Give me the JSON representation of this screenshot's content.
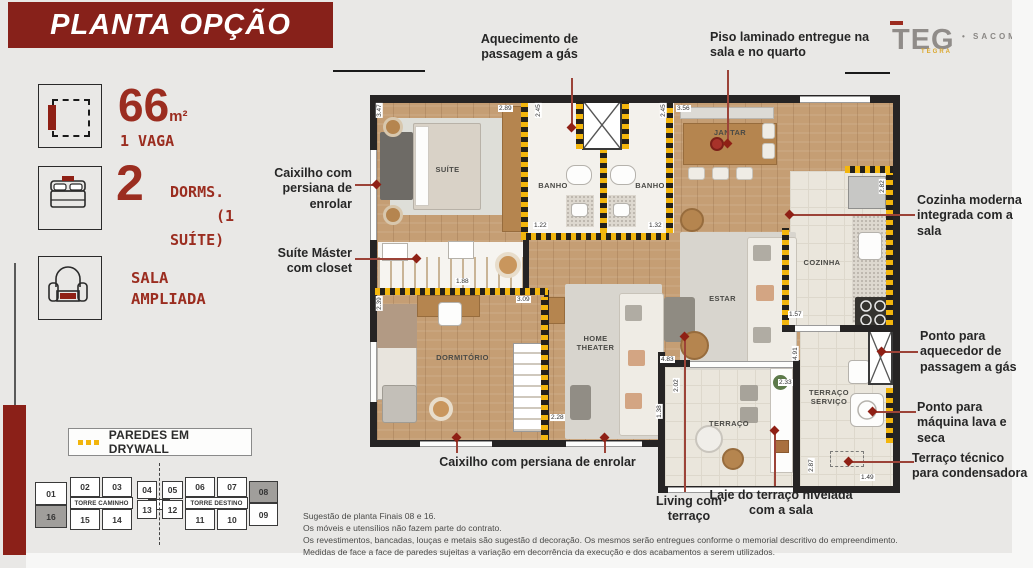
{
  "header": {
    "title": "PLANTA OPÇÃO"
  },
  "logo": {
    "name": "TEG",
    "sub": "TEGRA",
    "bullet": "•",
    "location": "SACOMÃ"
  },
  "specs": {
    "area": "66",
    "area_unit": "m²",
    "vaga": "1 VAGA",
    "dorms_num": "2",
    "dorms_lines": [
      "DORMS.",
      "(1",
      "SUÍTE)"
    ],
    "sala_lines": [
      "SALA",
      "AMPLIADA"
    ]
  },
  "legend": {
    "label": "PAREDES EM DRYWALL"
  },
  "tower": {
    "top": [
      "01",
      "02",
      "03",
      "04",
      "05",
      "06",
      "07",
      "08"
    ],
    "bottom": [
      "16",
      "15",
      "14",
      "13",
      "12",
      "11",
      "10",
      "09"
    ],
    "highlighted": [
      "08",
      "16"
    ],
    "left_label": "TORRE CAMINHO",
    "right_label": "TORRE DESTINO"
  },
  "callouts": [
    "Aquecimento de passagem a gás",
    "Piso laminado entregue na sala e no quarto",
    "Caixilho com persiana de enrolar",
    "Suíte Máster com closet",
    "Cozinha moderna integrada com a sala",
    "Ponto para aquecedor de passagem a gás",
    "Ponto para máquina lava e seca",
    "Terraço técnico para condensadora",
    "Caixilho com persiana de enrolar",
    "Living com terraço",
    "Laje do terraço nivelada com a sala"
  ],
  "plan": {
    "rooms": [
      "SUÍTE",
      "BANHO",
      "BANHO",
      "JANTAR",
      "COZINHA",
      "ESTAR",
      "DORMITÓRIO",
      "HOME THEATER",
      "TERRAÇO",
      "TERRAÇO SERVIÇO"
    ],
    "dims": [
      "3.47",
      "2.89",
      "2.45",
      "2.45",
      "3.56",
      "1.22",
      "1.32",
      "2.82",
      "1.88",
      "2.39",
      "3.09",
      "2.28",
      "1.57",
      "4.83",
      "4.91",
      "2.02",
      "1.38",
      "2.33",
      "2.87",
      "1.49"
    ]
  },
  "disclaimer": [
    "Sugestão de planta Finais 08 e 16.",
    "Os móveis e utensílios não fazem parte do contrato.",
    "Os revestimentos, bancadas, louças e metais são sugestão d decoração. Os mesmos serão entregues conforme o memorial descritivo do empreendimento.",
    "Medidas de face a face de paredes sujeitas a variação em decorrência da execução e dos acabamentos a serem utilizados."
  ],
  "colors": {
    "accent": "#87211a",
    "number_red": "#9b2d20",
    "drywall_yellow": "#f3b60d"
  }
}
